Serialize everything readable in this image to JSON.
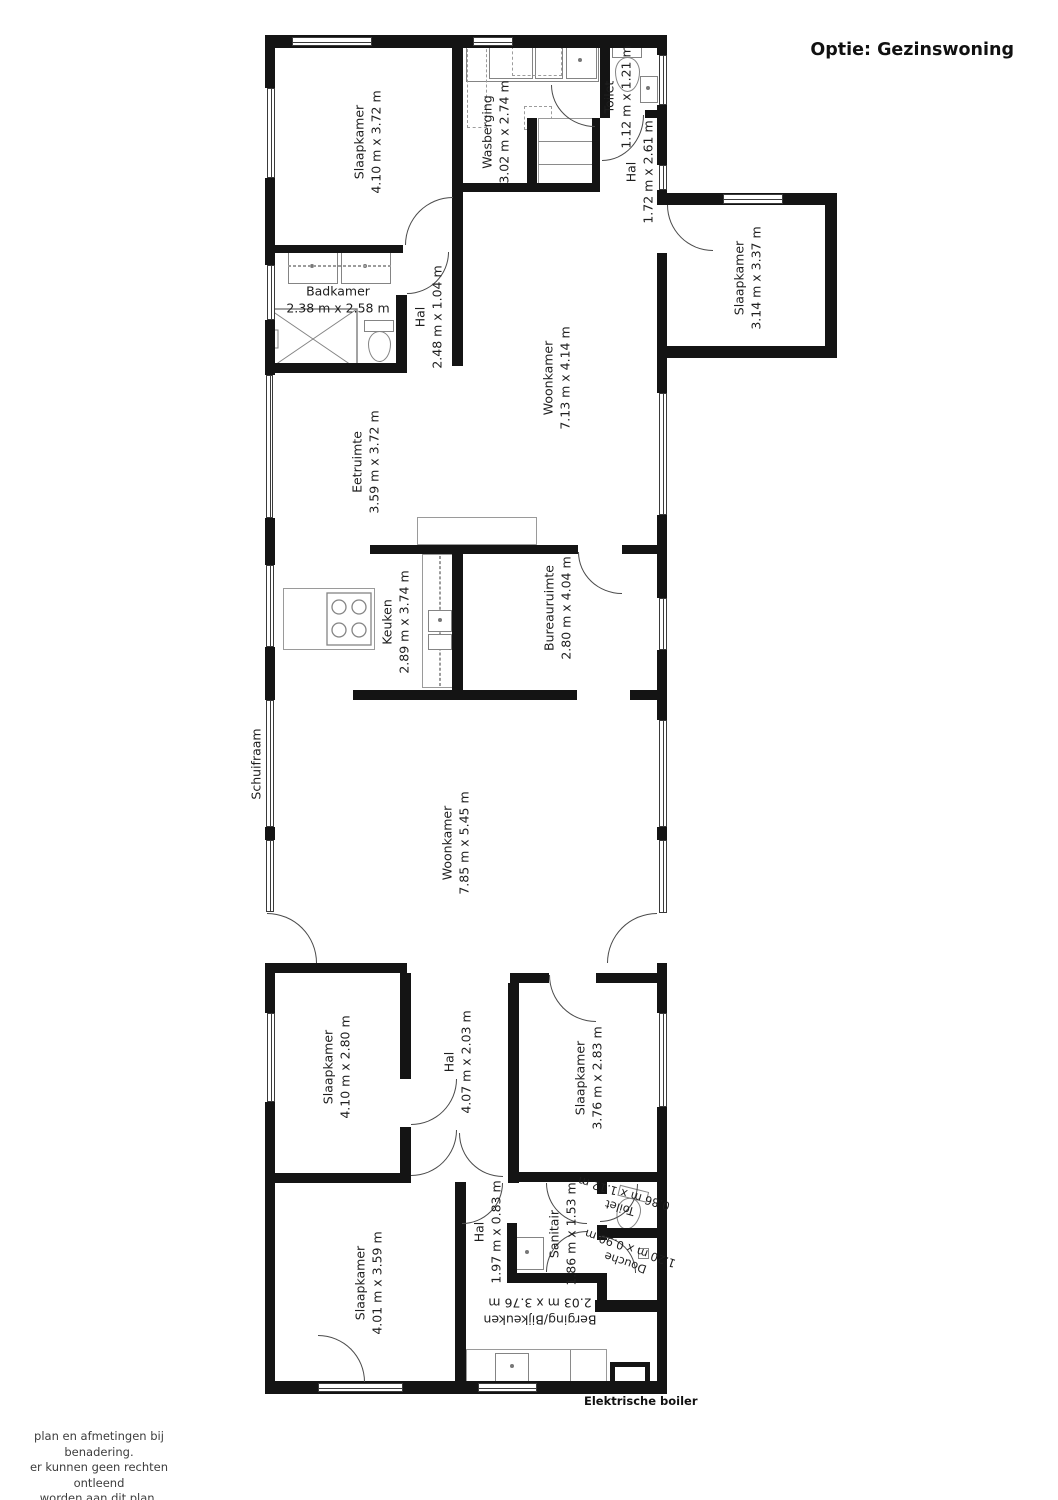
{
  "title": "Optie: Gezinswoning",
  "rooms": {
    "slaapkamer_tl": {
      "name": "Slaapkamer",
      "dims": "4.10 m x 3.72 m"
    },
    "wasberging": {
      "name": "Wasberging",
      "dims": "3.02 m x 2.74 m"
    },
    "toilet_top": {
      "name": "Toilet",
      "dims": "1.12 m x 1.21 m"
    },
    "hal_top": {
      "name": "Hal",
      "dims": "1.72 m x 2.61 m"
    },
    "slaapkamer_tr": {
      "name": "Slaapkamer",
      "dims": "3.14 m x 3.37 m"
    },
    "badkamer": {
      "name": "Badkamer",
      "dims": "2.38 m x 2.58 m"
    },
    "hal_mid": {
      "name": "Hal",
      "dims": "2.48 m x 1.04 m"
    },
    "woonkamer_boven": {
      "name": "Woonkamer",
      "dims": "7.13 m x 4.14 m"
    },
    "eetruimte": {
      "name": "Eetruimte",
      "dims": "3.59 m x 3.72 m"
    },
    "keuken": {
      "name": "Keuken",
      "dims": "2.89 m x 3.74 m"
    },
    "bureauruimte": {
      "name": "Bureauruimte",
      "dims": "2.80 m x 4.04 m"
    },
    "woonkamer": {
      "name": "Woonkamer",
      "dims": "7.85 m x 5.45 m"
    },
    "slaapkamer_links": {
      "name": "Slaapkamer",
      "dims": "4.10 m x 2.80 m"
    },
    "hal_midden": {
      "name": "Hal",
      "dims": "4.07 m x 2.03 m"
    },
    "slaapkamer_rechts": {
      "name": "Slaapkamer",
      "dims": "3.76 m x 2.83 m"
    },
    "slaapkamer_onder": {
      "name": "Slaapkamer",
      "dims": "4.01 m x 3.59 m"
    },
    "hal_onder": {
      "name": "Hal",
      "dims": "1.97 m x 0.83 m"
    },
    "sanitair": {
      "name": "Sanitair",
      "dims": "1.86 m x 1.53 m"
    },
    "toilet_onder": {
      "name": "Toilet",
      "dims": "0.86 m x 1.12 m"
    },
    "douche": {
      "name": "Douche",
      "dims": "1.20 m x 0.90 m"
    },
    "berging": {
      "name": "Berging/Bijkeuken",
      "dims": "2.03 m x 3.76 m"
    }
  },
  "annotations": {
    "schuifraam": "Schuifraam",
    "boiler": "Elektrische boiler"
  },
  "disclaimer": {
    "line1": "plan en afmetingen bij benadering.",
    "line2": "er kunnen geen rechten ontleend",
    "line3": "worden aan dit plan.",
    "line4": "copyright Frame 24"
  },
  "colors": {
    "wall": "#141414",
    "text": "#1e1e1e",
    "fixture": "#848484"
  }
}
